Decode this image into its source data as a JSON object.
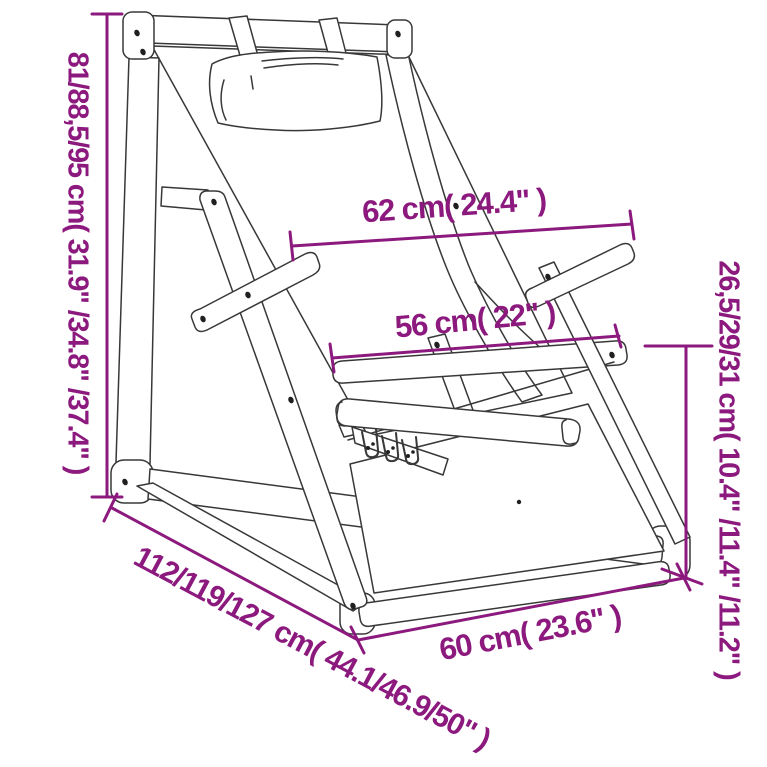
{
  "diagram": {
    "subject": "folding deck chair with headrest pillow, line drawing with dimension annotations",
    "labels": {
      "height": "81/88,5/95 cm( 31.9\" /34.8\" /37.4\" )",
      "top_width": "62 cm( 24.4\" )",
      "seat_width": "56 cm( 22\" )",
      "seat_height": "26,5/29/31 cm( 10.4\" /11.4\" /11.2\" )",
      "depth": "112/119/127 cm( 44.1/46.9/50\" )",
      "bottom_width": "60 cm( 23.6\" )"
    },
    "colors": {
      "annotation": "#8C197D",
      "line_art": "#383838",
      "background": "#FFFFFF"
    }
  }
}
